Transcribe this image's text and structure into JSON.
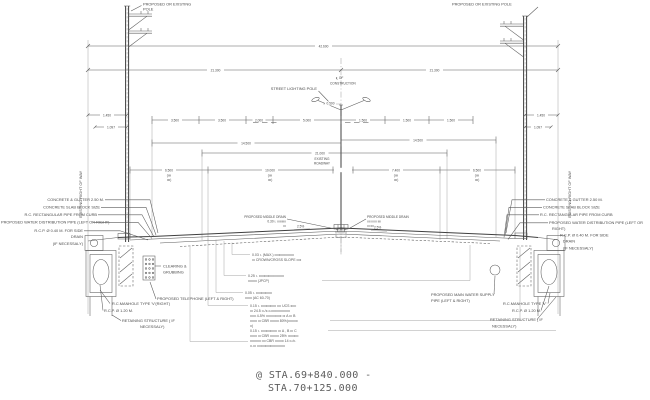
{
  "station": {
    "l1": "@ STA.69+840.000  -",
    "l2": "STA.70+125.000"
  },
  "labels": {
    "pole_left_1": "PROPOSED OR EXISTING",
    "pole_left_2": "POLE",
    "pole_right": "PROPOSED OR EXISTING POLE",
    "street_pole": "STREET LIGHTING POLE",
    "cl_1": "℄ OF",
    "cl_2": "CONSTRUCTION",
    "row_left": "EXISTING RIGHT OF WAY",
    "row_right": "EXISTING RIGHT OF WAY",
    "roadway_1": "EXISTING",
    "roadway_2": "ROADWAY",
    "drain_l1": "PROPOSED MIDDLE DRAIN",
    "drain_l2": "0.30 ı. ıııııııııı",
    "drain_l3": "ııı",
    "drain_r1": "PROPOSED MIDDLE DRAIN",
    "drain_r2": "ıııı ıııııı ıııı",
    "drain_r3": "ııı ıııı",
    "slope_left": "2.5%",
    "slope_right": "2.5%",
    "clearing_1": "CLEARING &",
    "clearing_2": "GRUBBING",
    "telephone": "PROPOSED TELEPHONE (LEFT & RIGHT)",
    "manhole_left": "R.C.MANHOLE TYPE 'V'(RIGHT)",
    "manhole_right": "R.C.MANHOLE TYPE 'V'",
    "rcp_120": "R.C.P. Ø 1.20 M.",
    "retaining_1": "RETAINING STRUCTURE ( IF",
    "retaining_2": "NECESSALY)",
    "water_1": "PROPOSED MAIN WATER SUPPLY",
    "water_2": "PIPE (LEFT & RIGHT)"
  },
  "left_stack": [
    "CONCRETE & GUTTER 2.50 M.",
    "CONCRETE SLAB BLOCK SIZE",
    "R.C. RECTANGULAR PIPE FROM CURB",
    "PROPOSED WATER DISTRIBUTION PIPE (LEFT OR RIGHT)",
    "R.C.P. Ø 0.40 M. FOR SIDE",
    "DRAIN",
    "(IF NECESSALY)"
  ],
  "right_stack": [
    "CONCRETE & GUTTER 2.50 M.",
    "CONCRETE SLAB BLOCK SIZE",
    "R.C. RECTANGULAR PIPE FROM CURB",
    "PROPOSED WATER DISTRIBUTION PIPE (LEFT OR",
    "RIGHT)",
    "R.C.P. Ø 0.40 M. FOR SIDE",
    "DRAIN",
    "(IF NECESSALY)"
  ],
  "dims": {
    "overall": "42.600",
    "half_l": "21.300",
    "half_r": "21.300",
    "l1450": "1.450",
    "l1097": "1.097",
    "r1450": "1.450",
    "r1097": "1.097",
    "d3500a": "3.500",
    "d3500b": "3.500",
    "d2000": "2.000",
    "d5000": "5.000",
    "off500": "0.500",
    "r1500a": "1.500",
    "r1500b": "1.500",
    "r1500c": "1.500",
    "l14500": "14.500",
    "r14500": "14.500",
    "c21000": "21.000",
    "b6500l": "6.500",
    "b10000": "10.000",
    "b7400": "7.400",
    "b6500r": "6.500",
    "sub_open": "(ıııı",
    "sub_close": "ıııı)"
  },
  "notes": [
    "0.03 ı. (MAX.) ıııııııııııııııııııı",
    "ııı CROWN/CROSS SLOPE ııııı",
    "0.25 ı. ıııııııııııııııııııııııııı",
    "ııııııııı (JPCP)",
    "0.05 ı. ııııııııııııııııı",
    "ııııııı (AC 60-70)",
    "0.15 ı. ıııııııııııııııı ıııı UCS ıııııı",
    "ııı 24.5 ıı./ıı.ıı.ııııııııııııııııııı",
    "ıııııı 4-5% ıııııııııııııııı ııı A ııı B",
    "ııııııı ııı CBR ııııııııı 80%(ıııııııııı",
    "ıı)",
    "0.15 ı. ııııııııııııııııı ııı A , B ııı C",
    "ııııııı ııı CBR ııııııııı 25% ııııııııııı",
    "ııııııııııı ıııı CBR ııııııııı 14 ıı./ıı.",
    "ıı.ııı ııııııııııııııııııııııııııııı"
  ]
}
